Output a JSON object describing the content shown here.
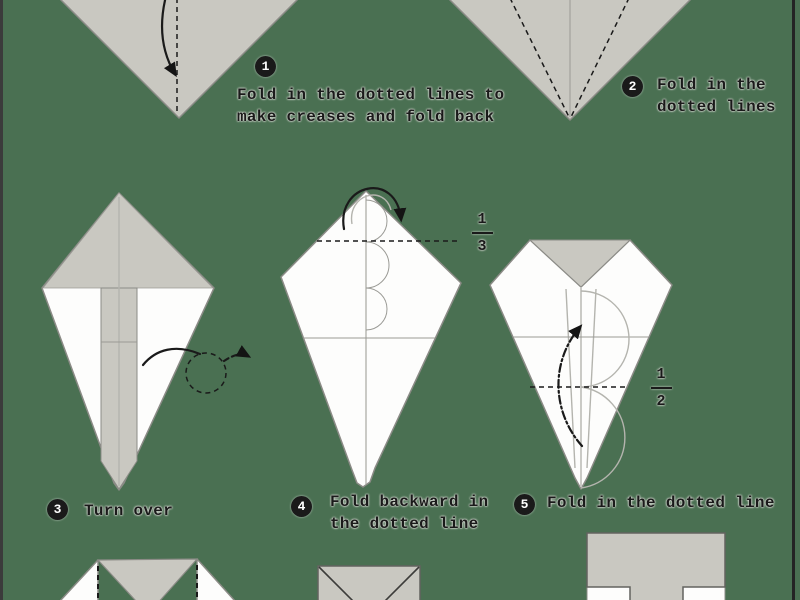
{
  "page": {
    "background": "#4a7052",
    "description": "Origami folding instructions sheet, steps 1-5 visible with partial shapes of later steps at top and bottom edges"
  },
  "palette": {
    "background": "#4a7052",
    "paper_gray": "#c9c8c1",
    "paper_white": "#fdfdfc",
    "outline": "#8b8b86",
    "outline_dark": "#63635f",
    "guide": "#9a9a95",
    "guide_light": "#b4b4ae",
    "ink": "#1a1a1a",
    "left_edge": "#3b3b3b",
    "right_edge": "#242424"
  },
  "steps": [
    {
      "number": "1",
      "lines": [
        "Fold in the dotted lines to",
        "make creases and fold back"
      ]
    },
    {
      "number": "2",
      "lines": [
        "Fold in the",
        "dotted lines"
      ]
    },
    {
      "number": "3",
      "lines": [
        "Turn over"
      ]
    },
    {
      "number": "4",
      "lines": [
        "Fold backward in",
        "the dotted line"
      ]
    },
    {
      "number": "5",
      "lines": [
        "Fold in the dotted line"
      ]
    }
  ],
  "fractions": [
    {
      "numerator": "1",
      "denominator": "3"
    },
    {
      "numerator": "1",
      "denominator": "2"
    }
  ],
  "icons": {
    "step1_arrow": "curved-fold-down-arrow",
    "step3_arrow": "turn-over-loop-arrow",
    "step4_arrow": "roll-over-top-arrow",
    "step5_arrow": "fold-up-dash-dot-arrow",
    "fold_lines": "dashed-fold-line"
  }
}
